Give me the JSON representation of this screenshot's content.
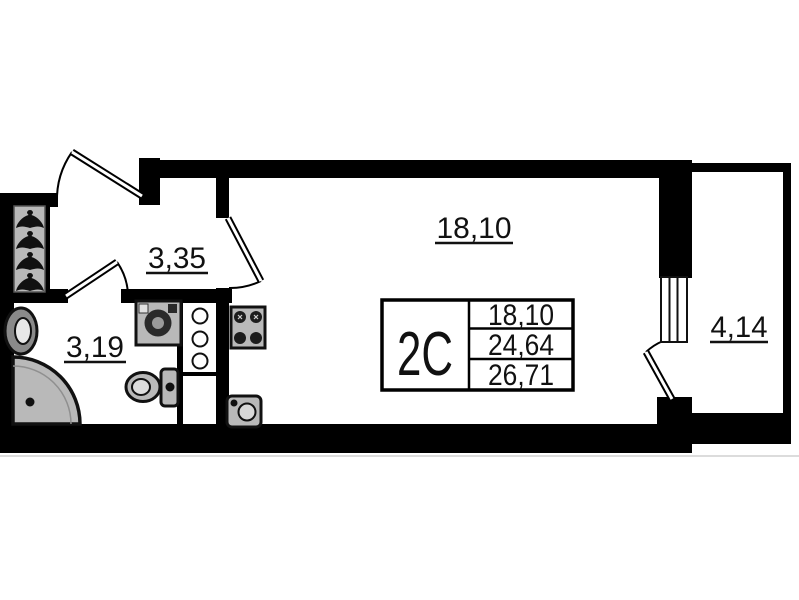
{
  "plan": {
    "type": "apartment-floor-plan",
    "unit_label": "2C",
    "rooms": [
      {
        "id": "main-room",
        "area": "18,10"
      },
      {
        "id": "hallway",
        "area": "3,35"
      },
      {
        "id": "bathroom",
        "area": "3,19"
      },
      {
        "id": "balcony",
        "area": "4,14"
      }
    ],
    "info_table": {
      "unit": "2C",
      "rows": [
        "18,10",
        "24,64",
        "26,71"
      ]
    },
    "fixtures": [
      "coat-hooks",
      "washbasin",
      "shower-cabin",
      "washing-machine",
      "toilet",
      "ventilation-duct",
      "stove",
      "kitchen-sink",
      "balcony-window"
    ],
    "doors": [
      "entrance-door",
      "main-room-door",
      "bathroom-door",
      "balcony-door"
    ],
    "colors": {
      "wall": "#000000",
      "background": "#ffffff",
      "fixture_fill": "#b9b9b9",
      "fixture_dark": "#2a2a2a",
      "text": "#111111"
    }
  }
}
